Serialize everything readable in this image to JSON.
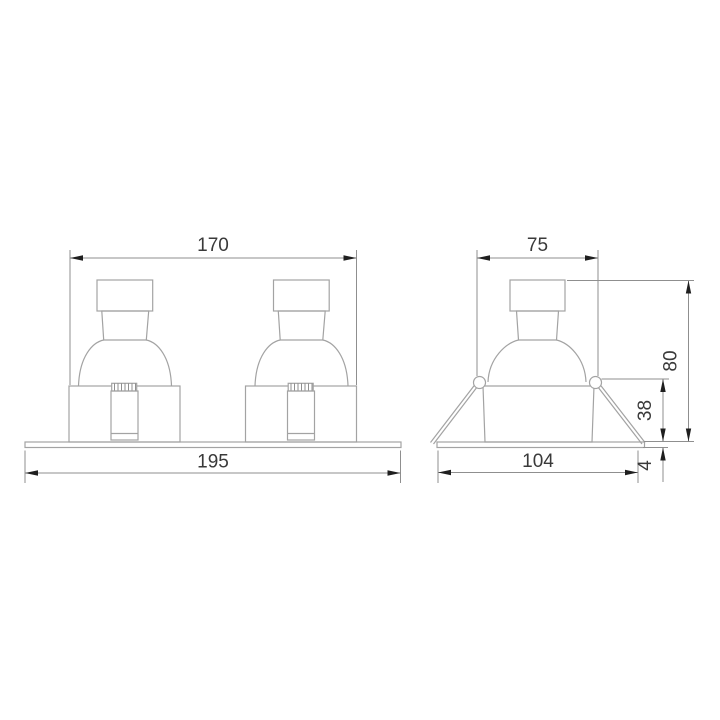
{
  "drawing": {
    "title": "recessed-downlight-dimension-drawing",
    "front_view": {
      "name": "double-spotlight-front-view",
      "width_top": "170",
      "width_base": "195"
    },
    "side_view": {
      "name": "single-spotlight-side-view",
      "width_top": "75",
      "width_base": "104",
      "height_total": "80",
      "height_body": "38",
      "flange_thickness": "4"
    },
    "colors": {
      "background": "#ffffff",
      "geometry_line": "#a3a3a3",
      "dimension_line": "#8f8f8f",
      "arrow": "#1f1f1f",
      "text": "#3a3a3a"
    }
  }
}
